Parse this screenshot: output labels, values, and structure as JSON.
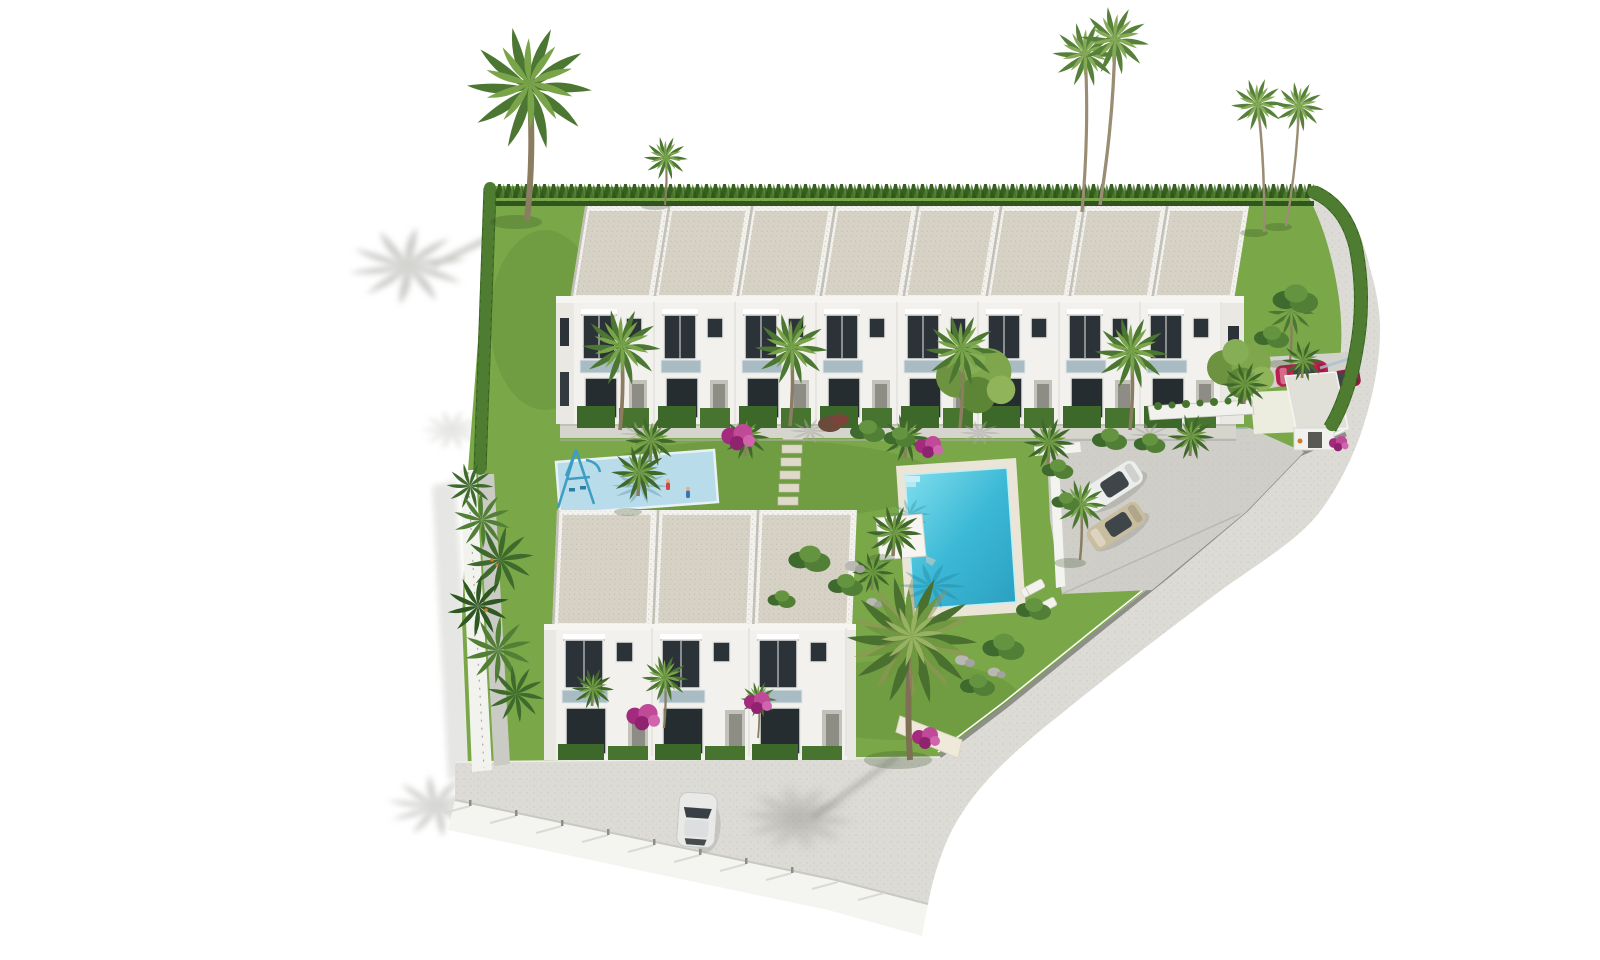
{
  "scene": {
    "title": "Aerial 3D render of a residential townhouse development",
    "type": "architectural-visualization",
    "view": "aerial three-quarter bird's-eye",
    "background": "#ffffff"
  },
  "palette": {
    "lawn": "#7aa748",
    "lawn_dark": "#23430f",
    "hedge": "#35601f",
    "hedge_light": "#4e7c30",
    "roof": "#d7d2c6",
    "roof_frame": "#f3f2ee",
    "facade": "#f2f1ed",
    "facade_shadow": "#deddd8",
    "window_glass": "#2c3338",
    "balcony_glass": "#9db3bd",
    "pool_water": "#3cb9d6",
    "pool_deck": "#eae5d6",
    "playground_pad": "#b9dcea",
    "play_equipment": "#3d9dc2",
    "road": "#dcdbd6",
    "parking": "#cfcec8",
    "wall_white": "#f4f4f1",
    "wall_shadow": "#c9c9c4",
    "path_stone": "#ded9c8",
    "shadow_grey": "#c9c9c6",
    "bougainvillea": "#b93b8e",
    "palm_green": "#6d9a44",
    "palm_dark": "#4f7a34",
    "trunk": "#8b7d62",
    "car_white": "#eceeec",
    "car_tan": "#c9bda0",
    "car_red": "#b81e4e",
    "car_maroon": "#8e2240"
  },
  "site": {
    "buildings": [
      {
        "id": "north-row",
        "type": "townhouse-row",
        "units": 8,
        "floors": 2,
        "roof": "flat-gravel",
        "features": [
          "awnings",
          "glass-balconies",
          "front-patios-with-hedges"
        ]
      },
      {
        "id": "south-block",
        "type": "townhouse-row",
        "units": 3,
        "floors": 2,
        "roof": "flat-gravel",
        "features": [
          "awnings",
          "glass-balconies",
          "front-hedges"
        ]
      }
    ],
    "amenities": [
      {
        "id": "main-pool",
        "type": "swimming-pool",
        "shape": "rectangular",
        "deck": "stone",
        "loungers": 2
      },
      {
        "id": "kids-playground",
        "type": "playground",
        "surface": "rubber-soft-blue",
        "equipment": [
          "swing-pyramid",
          "slide"
        ]
      },
      {
        "id": "parking-area",
        "type": "open-parking",
        "cars_parked": 2
      },
      {
        "id": "entrance-gatehouse",
        "type": "gate-pavilion",
        "canopy": "sloped"
      },
      {
        "id": "stepping-stone-path",
        "type": "garden-path"
      },
      {
        "id": "ring-road",
        "type": "perimeter-road"
      }
    ],
    "vehicles": [
      {
        "id": "suv",
        "color": "white",
        "location": "parking-area"
      },
      {
        "id": "sedan",
        "color": "beige",
        "location": "parking-area"
      },
      {
        "id": "car-red",
        "color": "red",
        "location": "entrance-driveway"
      },
      {
        "id": "car-maroon",
        "color": "dark-red",
        "location": "entrance-driveway"
      },
      {
        "id": "hatchback",
        "color": "white",
        "location": "south-road"
      }
    ],
    "vegetation": {
      "tall_palms": 6,
      "medium_palms": 16,
      "round_trees": 2,
      "bougainvillea_clusters": 6,
      "perimeter_hedges": true,
      "communal_lawns": true
    },
    "people": [
      {
        "id": "children",
        "count": 2,
        "location": "kids-playground"
      },
      {
        "id": "person",
        "count": 1,
        "location": "entrance-gatehouse"
      }
    ]
  }
}
